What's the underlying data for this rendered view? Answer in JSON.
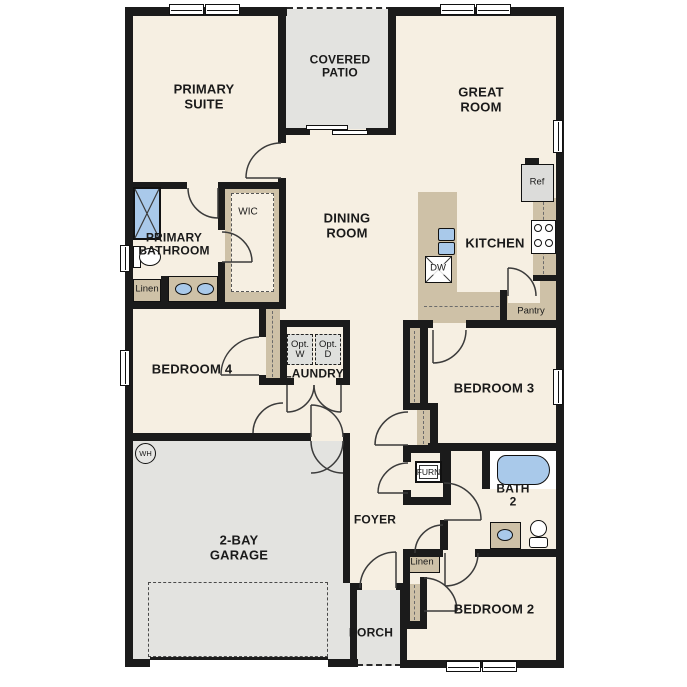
{
  "plan": {
    "rooms": {
      "primary_suite": "PRIMARY\nSUITE",
      "covered_patio": "COVERED\nPATIO",
      "great_room": "GREAT\nROOM",
      "dining_room": "DINING\nROOM",
      "kitchen": "KITCHEN",
      "primary_bathroom": "PRIMARY\nBATHROOM",
      "wic": "WIC",
      "bedroom_4": "BEDROOM 4",
      "laundry": "LAUNDRY",
      "bedroom_3": "BEDROOM 3",
      "garage": "2-BAY\nGARAGE",
      "foyer": "FOYER",
      "bath_2": "BATH\n2",
      "bedroom_2": "BEDROOM 2",
      "porch": "PORCH"
    },
    "fixtures": {
      "refrigerator": "Ref",
      "dishwasher": "DW",
      "pantry": "Pantry",
      "linen_primary": "Linen",
      "linen_hall": "Linen",
      "opt_washer": "Opt.\nW",
      "opt_dryer": "Opt.\nD",
      "furnace": "FURN",
      "water_heater": "WH"
    },
    "colors": {
      "floor": "#f6efe2",
      "outdoor": "#e3e3e0",
      "cabinet": "#cec1a7",
      "fixture_blue": "#a9c9ea",
      "wall": "#1b1b1b"
    }
  }
}
